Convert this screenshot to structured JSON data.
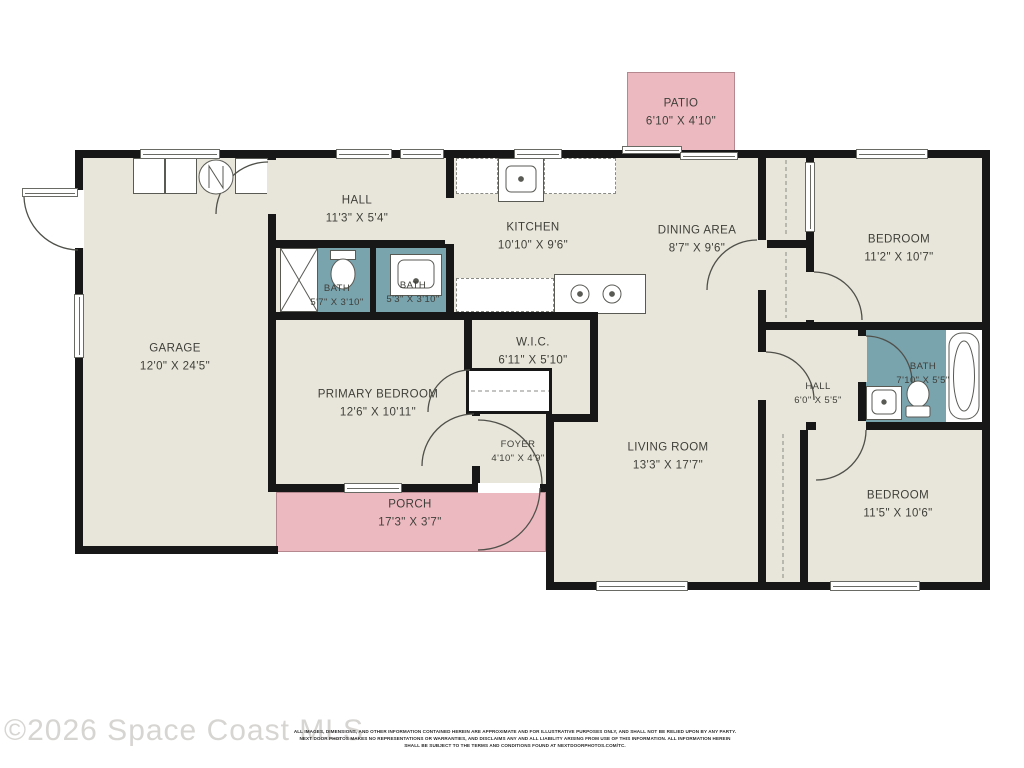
{
  "colors": {
    "floor": "#e8e6da",
    "wall": "#171717",
    "outdoor_pink": "#ecb9c0",
    "bath_teal": "#79a3ad",
    "label": "#3f3f39"
  },
  "watermark": "©2026 Space Coast MLS",
  "disclaimer": {
    "line1": "ALL IMAGES, DIMENSIONS, AND OTHER INFORMATION CONTAINED HEREIN ARE APPROXIMATE AND FOR ILLUSTRATIVE PURPOSES ONLY, AND SHALL NOT BE RELIED UPON BY ANY PARTY.",
    "line2": "NEXT DOOR PHOTOS MAKES NO REPRESENTATIONS OR WARRANTIES, AND DISCLAIMS ANY AND ALL LIABILITY ARISING FROM USE OF THIS INFORMATION. ALL INFORMATION HEREIN",
    "line3": "SHALL BE SUBJECT TO THE TERMS AND CONDITIONS FOUND AT NEXTDOORPHOTOS.COM/TC."
  },
  "rooms": {
    "patio": {
      "name": "PATIO",
      "dims": "6'10\" X 4'10\""
    },
    "garage": {
      "name": "GARAGE",
      "dims": "12'0\" X 24'5\""
    },
    "hall_top": {
      "name": "HALL",
      "dims": "11'3\" X 5'4\""
    },
    "kitchen": {
      "name": "KITCHEN",
      "dims": "10'10\" X 9'6\""
    },
    "dining": {
      "name": "DINING AREA",
      "dims": "8'7\" X 9'6\""
    },
    "bedroom_top": {
      "name": "BEDROOM",
      "dims": "11'2\" X 10'7\""
    },
    "bath_small": {
      "name": "BATH",
      "dims": "5'7\" X 3'10\""
    },
    "bath_center": {
      "name": "BATH",
      "dims": "5'3\" X 3'10\""
    },
    "wic": {
      "name": "W.I.C.",
      "dims": "6'11\" X 5'10\""
    },
    "primary": {
      "name": "PRIMARY BEDROOM",
      "dims": "12'6\" X 10'11\""
    },
    "foyer": {
      "name": "FOYER",
      "dims": "4'10\" X 4'9\""
    },
    "living": {
      "name": "LIVING ROOM",
      "dims": "13'3\" X 17'7\""
    },
    "hall_right": {
      "name": "HALL",
      "dims": "6'0\" X 5'5\""
    },
    "bath_right": {
      "name": "BATH",
      "dims": "7'10\" X 5'5\""
    },
    "bedroom_bottom": {
      "name": "BEDROOM",
      "dims": "11'5\" X 10'6\""
    },
    "porch": {
      "name": "PORCH",
      "dims": "17'3\" X 3'7\""
    }
  }
}
